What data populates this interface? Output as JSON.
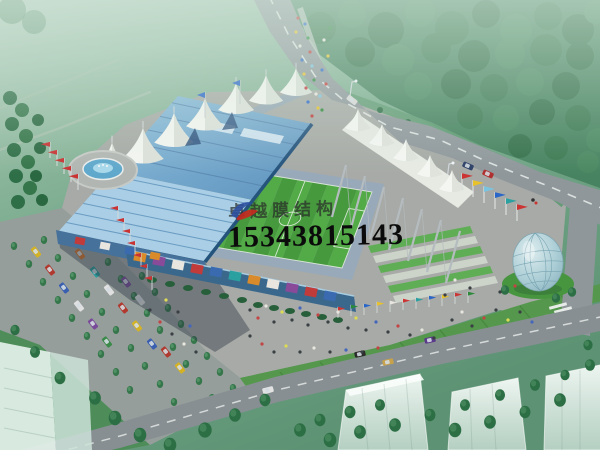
{
  "watermark": {
    "company_name": "卓越膜结构",
    "phone_number": "15343815143",
    "logo_icon": "swoosh-bird-logo",
    "name_color": "#2a2c2a",
    "phone_color": "#0b0b0b"
  },
  "scene": {
    "subject": "aerial architectural rendering of a membrane-roof stadium complex",
    "colors": {
      "mist_green": "#9dbfa7",
      "field_green": "#5f9273",
      "forest_green": "#3e7b55",
      "road_gray": "#8f979b",
      "plaza_gray": "#a7aaa6",
      "shadow": "#2a3842",
      "stand_blue": "#79aed2",
      "seat_blue": "#a9cee5",
      "roof_navy": "#24537c",
      "membrane_white": "#f3f5f0",
      "pitch_green": "#4aa040",
      "pitch_green_alt": "#53ab47",
      "terrace_green": "#5fae56",
      "dome_glass": "#a9ccd4",
      "mound_green": "#47963f",
      "water_blue": "#5fa8cc",
      "building_ghost": "#e8f1ec",
      "tree_dark": "#2d6f45",
      "flag_red": "#c93333"
    }
  }
}
